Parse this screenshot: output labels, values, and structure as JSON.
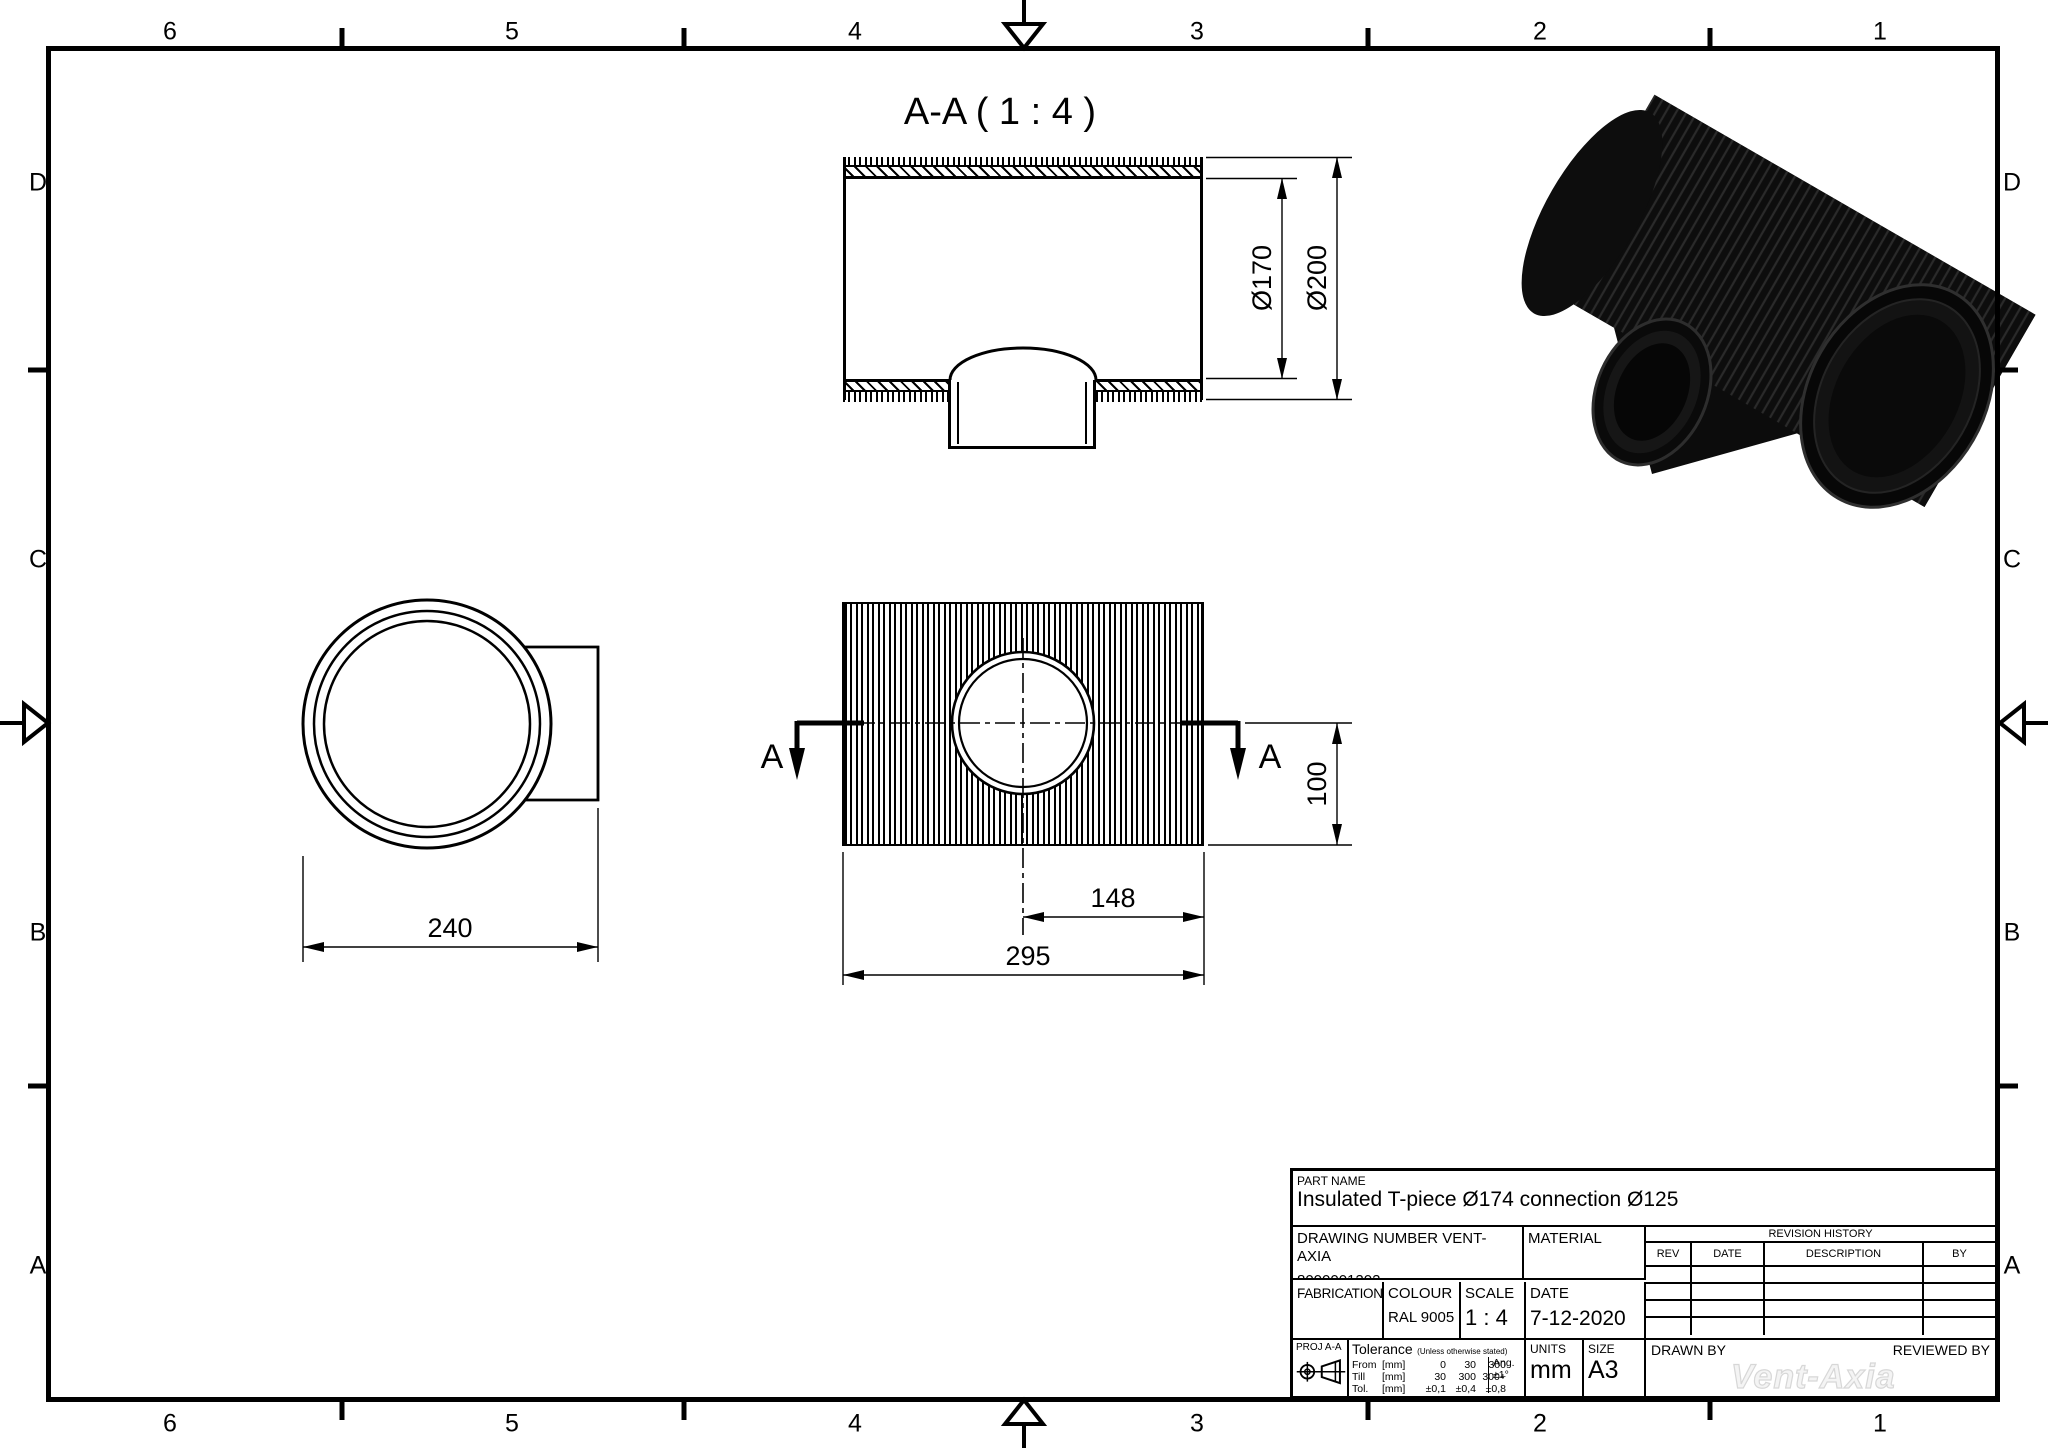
{
  "sheet": {
    "cols": [
      "6",
      "5",
      "4",
      "3",
      "2",
      "1"
    ],
    "rows": [
      "D",
      "C",
      "B",
      "A"
    ]
  },
  "views": {
    "section": {
      "title": "A-A ( 1 : 4 )",
      "dim_inner": "Ø170",
      "dim_outer": "Ø200"
    },
    "front": {
      "cut_label": "A",
      "dim_height": "100",
      "dim_center_to_end": "148",
      "dim_overall": "295"
    },
    "side": {
      "dim_overall": "240"
    }
  },
  "titleblock": {
    "part_name_label": "PART NAME",
    "part_name": "Insulated T-piece Ø174 connection Ø125",
    "drawing_number_label": "DRAWING NUMBER VENT-AXIA",
    "drawing_number": "8000001202",
    "material_label": "MATERIAL",
    "revision": {
      "title": "REVISION HISTORY",
      "col_rev": "REV",
      "col_date": "DATE",
      "col_description": "DESCRIPTION",
      "col_by": "BY"
    },
    "fabrication_label": "FABRICATION",
    "colour_label": "COLOUR",
    "colour": "RAL 9005",
    "scale_label": "SCALE",
    "scale": "1 : 4",
    "date_label": "DATE",
    "date": "7-12-2020",
    "proj_label": "PROJ A-A",
    "tolerance": {
      "title": "Tolerance",
      "note": "(Unless otherwise stated)",
      "rows": [
        {
          "label": "From",
          "unit": "[mm]",
          "values": [
            "0",
            "30",
            "300"
          ]
        },
        {
          "label": "Till",
          "unit": "[mm]",
          "values": [
            "30",
            "300",
            "300+"
          ]
        },
        {
          "label": "Tol.",
          "unit": "[mm]",
          "values": [
            "±0,1",
            "±0,4",
            "±0,8"
          ]
        }
      ],
      "ang_label": "Ang.",
      "ang_value": "±1°"
    },
    "units_label": "UNITS",
    "units": "mm",
    "size_label": "SIZE",
    "size": "A3",
    "drawn_by_label": "DRAWN BY",
    "reviewed_by_label": "REVIEWED BY",
    "watermark": "Vent-Axia"
  },
  "colors": {
    "line": "#000000",
    "watermark_fill": "#f4f4f4",
    "model_body": "#0d0d0d"
  }
}
